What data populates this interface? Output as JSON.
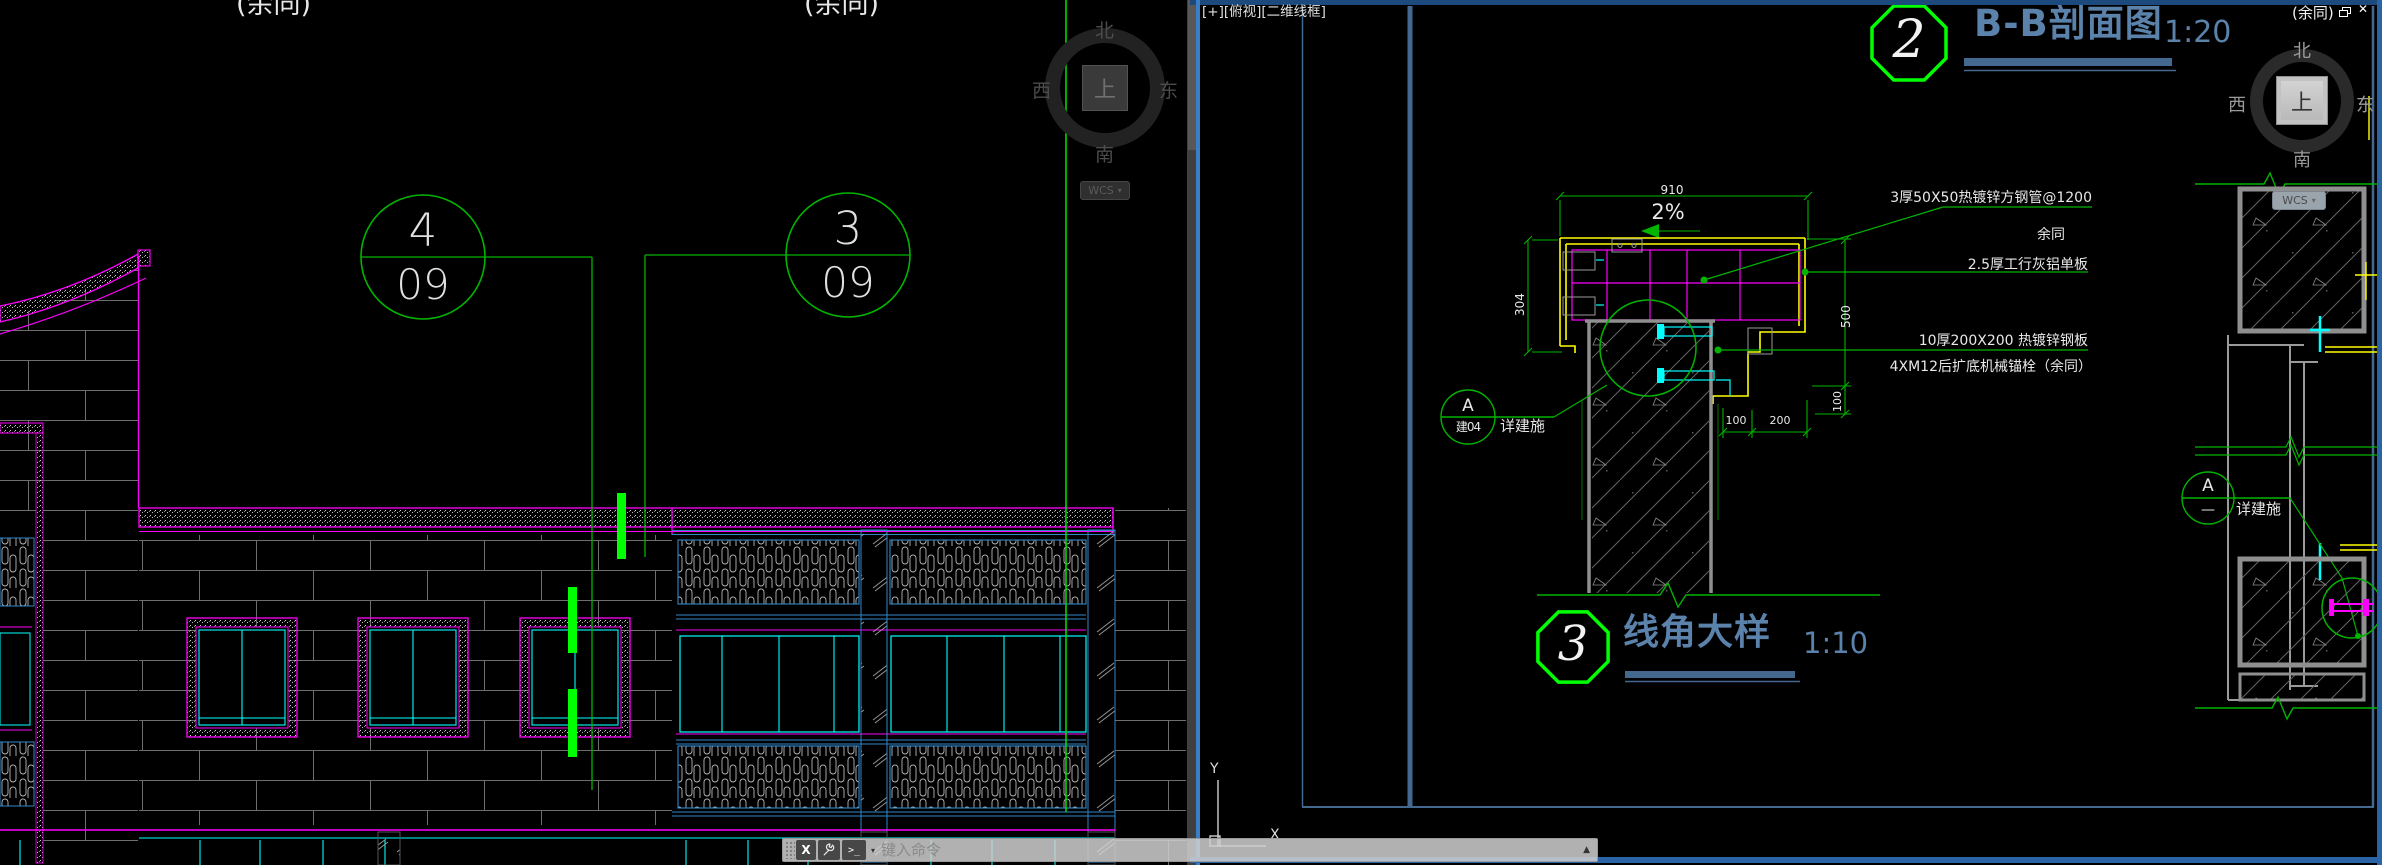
{
  "left_viewport": {
    "labels": {
      "yutong_left": "(余同)",
      "yutong_right": "(余同)"
    },
    "grid_bubbles": [
      {
        "number": "4",
        "sheet": "09"
      },
      {
        "number": "3",
        "sheet": "09"
      }
    ],
    "compass": {
      "north": "北",
      "south": "南",
      "west": "西",
      "east": "东",
      "up": "上",
      "wcs_label": "WCS"
    }
  },
  "right_viewport": {
    "title_bar": "[+][俯视][二维线框]",
    "overlay_label": "(余同)",
    "compass": {
      "north": "北",
      "south": "南",
      "west": "西",
      "east": "东",
      "up": "上",
      "wcs_label": "WCS"
    },
    "bb_section": {
      "bubble_number": "2",
      "title": "B-B剖面图",
      "scale": "1:20"
    },
    "corner_detail": {
      "bubble_number": "3",
      "title": "线角大样",
      "scale": "1:10"
    },
    "annotations": {
      "line1": "3厚50X50热镀锌方钢管@1200",
      "line2": "余同",
      "line3": "2.5厚工行灰铝单板",
      "line4": "10厚200X200 热镀锌钢板",
      "line5": "4XM12后扩底机械锚栓（余同）"
    },
    "dimensions": {
      "width": "910",
      "slope": "2%",
      "height_left": "304",
      "height_right": "500",
      "plate_height": "100",
      "offset1": "100",
      "offset2": "200"
    },
    "callout_main": {
      "top": "A",
      "bottom": "建04",
      "note": "详建施"
    },
    "callout_right": {
      "top": "A",
      "bottom": "—",
      "note": "详建施"
    },
    "ucs": {
      "x": "X",
      "y": "Y"
    }
  },
  "command_bar": {
    "close_label": "X",
    "prompt_label": "&gt;_",
    "prompt": ">_",
    "dropdown": "▾",
    "placeholder": "键入命令",
    "expand": "▲"
  },
  "colors": {
    "magenta": "#FF00FF",
    "cyan": "#00FFFF",
    "green": "#00B400",
    "lime": "#00FF00",
    "yellow": "#FFFF00",
    "bay_blue": "#2F86C8",
    "sheet_blue": "#44688F",
    "title_blue": "#5B82AB",
    "window_border": "#2F6FB8",
    "background": "#000000"
  }
}
